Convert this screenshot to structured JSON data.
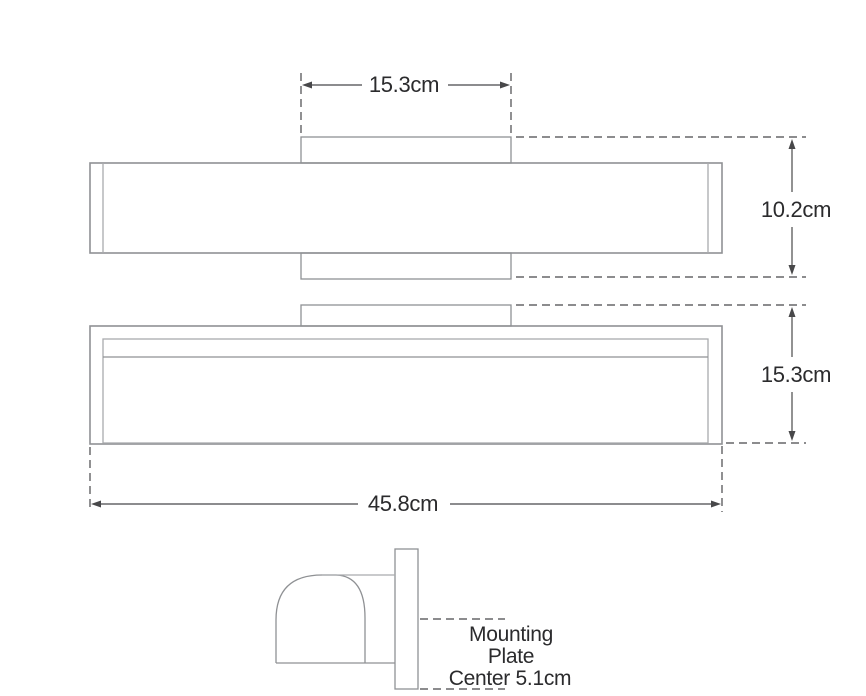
{
  "labels": {
    "bracket_width": "15.3cm",
    "depth": "10.2cm",
    "front_height": "15.3cm",
    "overall_width": "45.8cm",
    "mounting_note": {
      "line1": "Mounting",
      "line2": "Plate",
      "line3": "Center 5.1cm"
    }
  },
  "colors": {
    "background": "#ffffff",
    "object_outline": "#8f9194",
    "dimension_line": "#48484a",
    "label_text": "#2b2b2d"
  }
}
